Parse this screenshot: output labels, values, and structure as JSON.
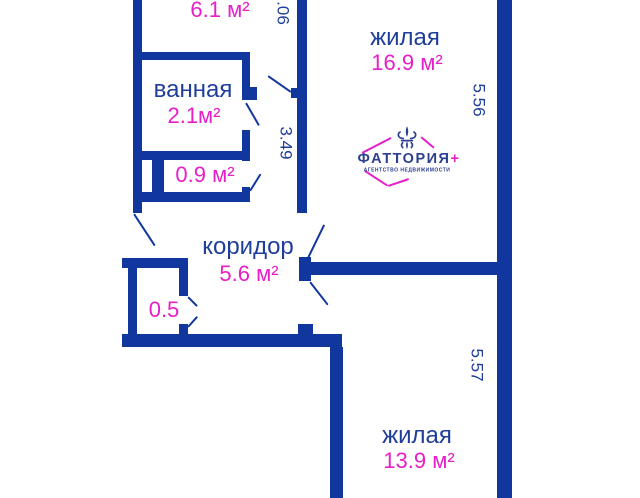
{
  "colors": {
    "wall": "#11379e",
    "blue": "#1f3e9c",
    "magenta": "#e61fc8",
    "logo_navy": "#2c4090"
  },
  "labels": {
    "room61_area": "6.1 м²",
    "bathroom_name": "ванная",
    "bathroom_area": "2.1м²",
    "room09_area": "0.9 м²",
    "corridor_name": "коридор",
    "corridor_area": "5.6 м²",
    "closet_area": "0.5",
    "living_top_name": "жилая",
    "living_top_area": "16.9 м²",
    "living_bottom_name": "жилая",
    "living_bottom_area": "13.9 м²"
  },
  "dimensions": {
    "top_right_partial": ".06",
    "middle_wall": "3.49",
    "right_upper": "5.56",
    "right_lower": "5.57"
  },
  "logo": {
    "brand": "ФАТТОРИЯ",
    "plus": "+",
    "tagline": "АГЕНТСТВО НЕДВИЖИМОСТИ",
    "icon": "fleur-de-lis"
  }
}
